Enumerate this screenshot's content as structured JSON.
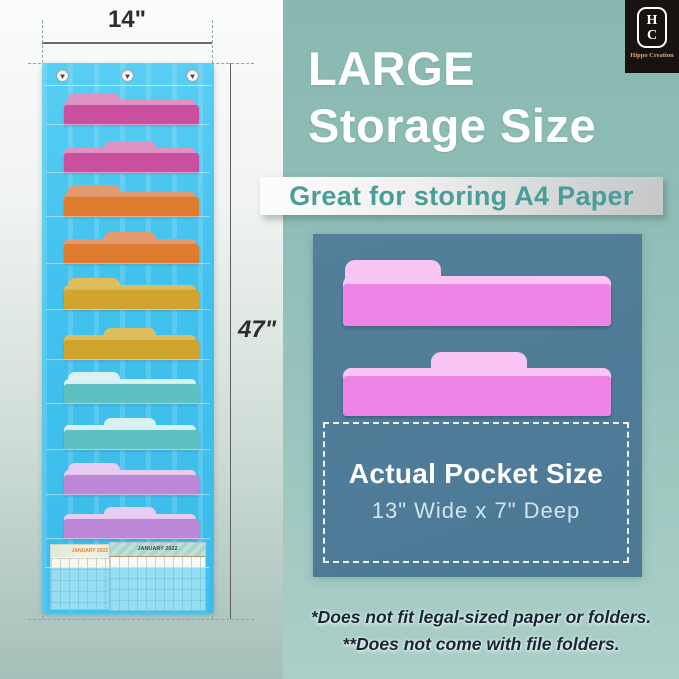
{
  "brand": {
    "monogram_top": "H",
    "monogram_bottom": "C",
    "name": "Hippo Creation"
  },
  "dimensions": {
    "width_label": "14\"",
    "height_label": "47\""
  },
  "organizer": {
    "grommet_count": 3,
    "fabric_color": "#41c2ee",
    "folders": [
      {
        "tab": "left",
        "color": "#cb4f9f",
        "tab_color": "#de93c3"
      },
      {
        "tab": "center",
        "color": "#cb4f9f",
        "tab_color": "#de93c3"
      },
      {
        "tab": "left",
        "color": "#df7b2f",
        "tab_color": "#e59a6d"
      },
      {
        "tab": "center",
        "color": "#df7b2f",
        "tab_color": "#e59a6d"
      },
      {
        "tab": "left",
        "color": "#d0a42d",
        "tab_color": "#ddbd5e"
      },
      {
        "tab": "center",
        "color": "#d0a42d",
        "tab_color": "#ddbd5e"
      },
      {
        "tab": "left",
        "color": "#5fc0c1",
        "tab_color": "#d9f1f2"
      },
      {
        "tab": "center",
        "color": "#5fc0c1",
        "tab_color": "#d9f1f2"
      },
      {
        "tab": "left",
        "color": "#bc87d7",
        "tab_color": "#e7ccf3"
      },
      {
        "tab": "center",
        "color": "#bc87d7",
        "tab_color": "#e7ccf3"
      }
    ],
    "calendars": [
      {
        "month": "JANUARY 2022"
      },
      {
        "month": "JANUARY 2022"
      }
    ]
  },
  "panel": {
    "title_line1": "LARGE",
    "title_line2": "Storage Size",
    "banner_text": "Great for storing A4 Paper",
    "accent_color": "#4a9d98",
    "inset": {
      "pocket_title": "Actual Pocket Size",
      "pocket_dims": "13\" Wide x 7\" Deep",
      "folder_color": "#ee85e6",
      "folder_tab_color": "#f9c6f4",
      "background_color": "#4b7996"
    },
    "notes": [
      "*Does not fit legal-sized paper or folders.",
      "**Does not come with file folders."
    ]
  }
}
